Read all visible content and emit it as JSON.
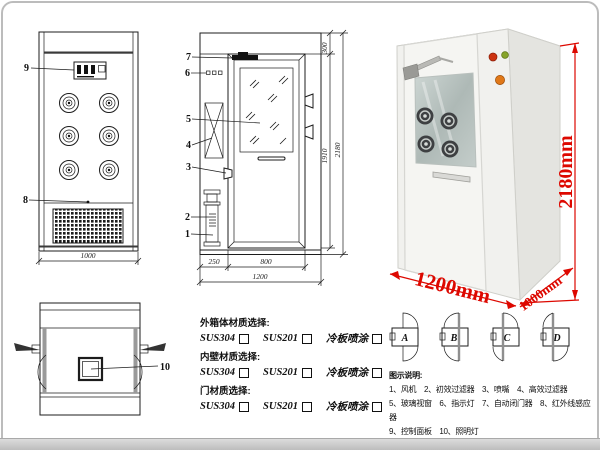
{
  "drawing": {
    "front_view": {
      "part_9": "9",
      "part_8": "8",
      "dim_width": "1000"
    },
    "side_view": {
      "part_7": "7",
      "part_6": "6",
      "part_5": "5",
      "part_4": "4",
      "part_3": "3",
      "part_2": "2",
      "part_1": "1",
      "dim_top": "300",
      "dim_door_h": "1910",
      "dim_total_h": "2180",
      "dim_left": "250",
      "dim_door_w": "800",
      "dim_total_w": "1200"
    },
    "plan_view": {
      "part_10": "10"
    }
  },
  "photo": {
    "dim_height": "2180mm",
    "dim_width": "1200mm",
    "dim_depth": "1000mm"
  },
  "materials": {
    "groups": [
      {
        "title": "外箱体材质选择:",
        "opt1": "SUS304",
        "opt2": "SUS201",
        "opt3": "冷板喷涂"
      },
      {
        "title": "内壁材质选择:",
        "opt1": "SUS304",
        "opt2": "SUS201",
        "opt3": "冷板喷涂"
      },
      {
        "title": "门材质选择:",
        "opt1": "SUS304",
        "opt2": "SUS201",
        "opt3": "冷板喷涂"
      }
    ]
  },
  "door_options": [
    "A",
    "B",
    "C",
    "D"
  ],
  "legend": {
    "title": "图示说明:",
    "line1": "1、风机　2、初效过滤器　3、喷嘴　4、高效过滤器",
    "line2": "5、玻璃视窗　6、指示灯　7、自动闭门器　8、红外线感应器",
    "line3": "9、控制面板　10、照明灯"
  },
  "colors": {
    "dimension_red": "#dd0800",
    "line_black": "#1c1c1c"
  }
}
